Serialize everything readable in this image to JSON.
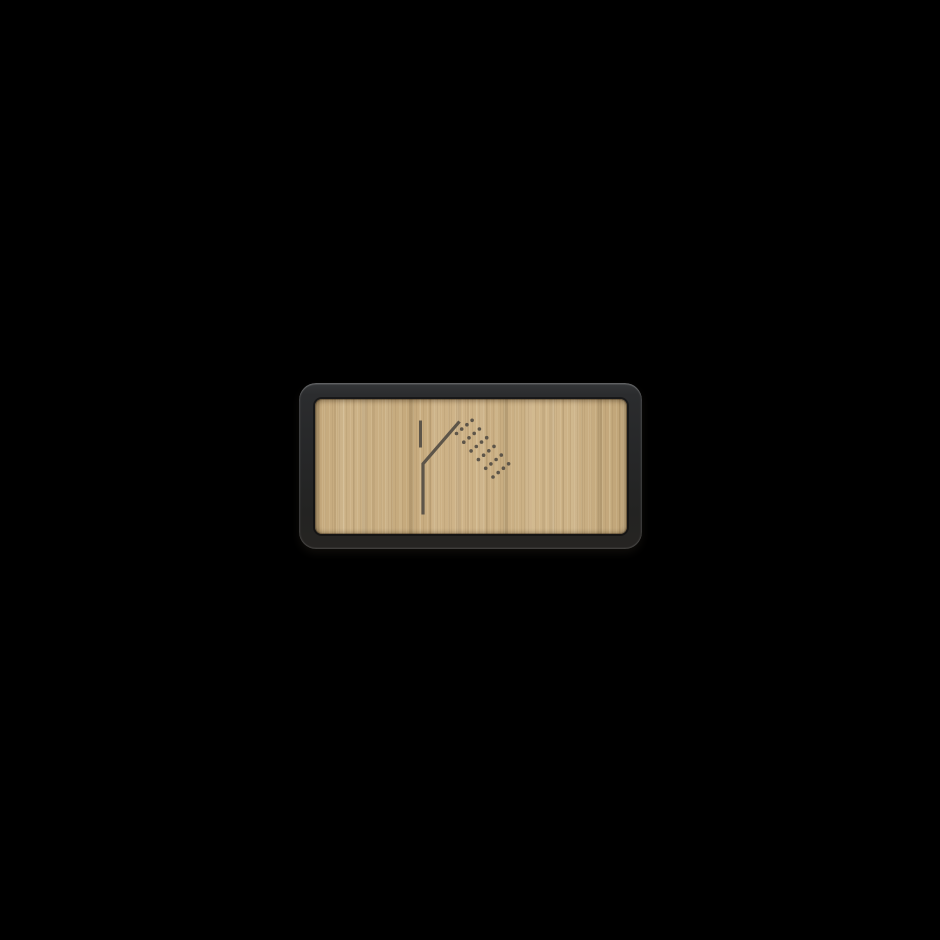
{
  "meta": {
    "description": "Rectangular shower-room door sign: dark charcoal rounded frame with light wood veneer panel and engraved shower pictogram, centered on a black background",
    "visible_text": ""
  },
  "colors": {
    "background": "#000000",
    "frame": "#27282a",
    "frame_highlight": "#5a5c5e",
    "frame_seam": "#121212",
    "wood_base": "#c9ae83",
    "wood_grain_dark": "#a98f66",
    "wood_grain_light": "#e2cda3",
    "icon": "#5d5549"
  },
  "sign": {
    "type_label": "shower-room-sign",
    "icon_name": "shower-icon",
    "icon_geometry": {
      "riser_stub": {
        "x": 420.5,
        "y1": 420.5,
        "y2": 447.5,
        "stroke_width": 3
      },
      "arm_and_pipe": {
        "points": [
          [
            459.5,
            421.5
          ],
          [
            423,
            463.8
          ],
          [
            423,
            514.5
          ]
        ],
        "stroke_width": 3.2
      },
      "spray": {
        "rows": 6,
        "dots_per_row": 4,
        "start": [
          456.5,
          433.5
        ],
        "row_step": [
          7.3,
          8.7
        ],
        "dot_step": [
          5.2,
          -4.4
        ],
        "dot_radius": 1.8
      }
    }
  }
}
